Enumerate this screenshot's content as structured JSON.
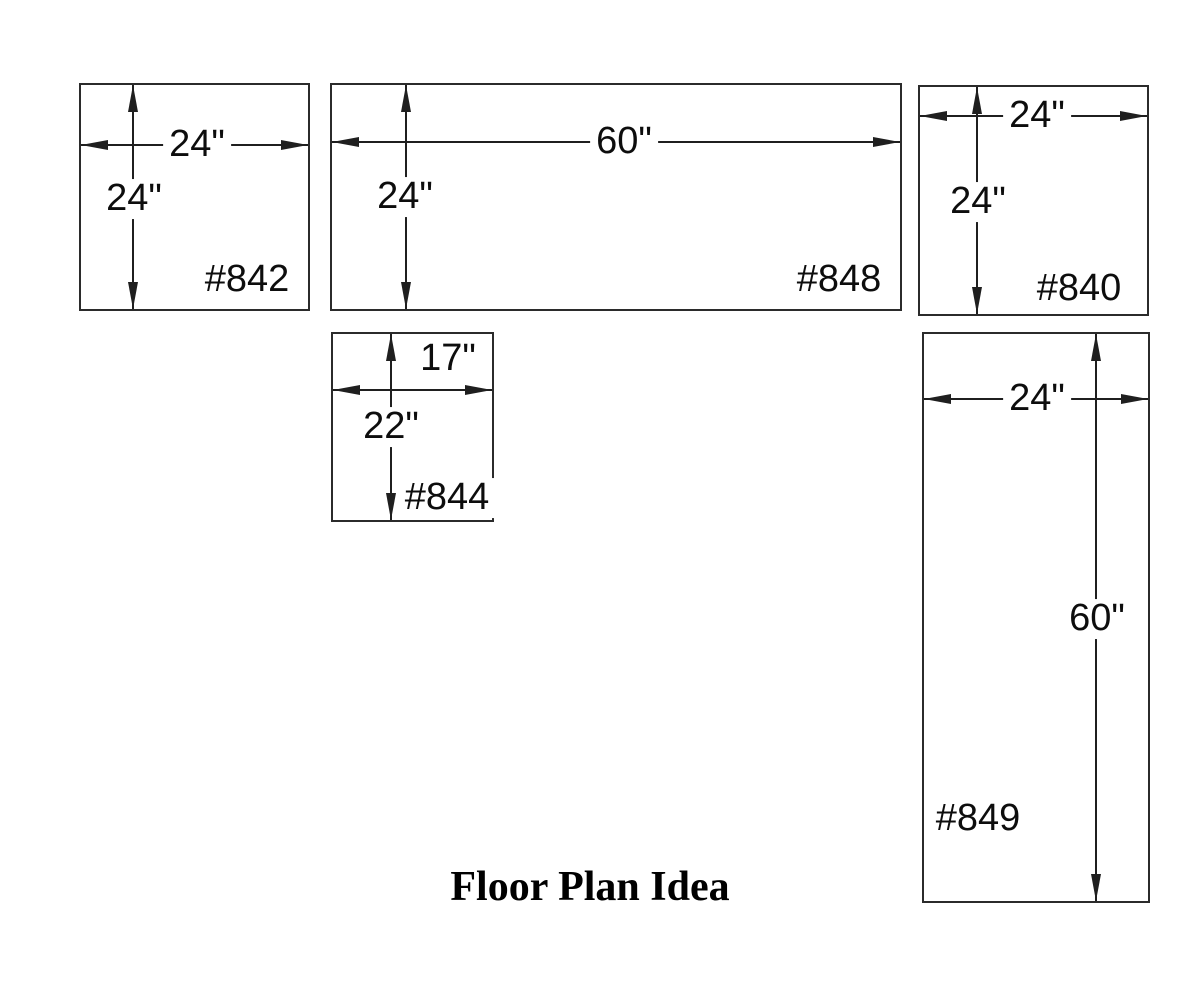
{
  "title": "Floor Plan Idea",
  "colors": {
    "line": "#1f1f1f",
    "border": "#2b2b2b",
    "background": "#ffffff",
    "text": "#0d0d0d"
  },
  "units": [
    {
      "id": "#842",
      "width_label": "24\"",
      "height_label": "24\"",
      "width_inches": 24,
      "height_inches": 24
    },
    {
      "id": "#848",
      "width_label": "60\"",
      "height_label": "24\"",
      "width_inches": 60,
      "height_inches": 24
    },
    {
      "id": "#840",
      "width_label": "24\"",
      "height_label": "24\"",
      "width_inches": 24,
      "height_inches": 24
    },
    {
      "id": "#844",
      "width_label": "17\"",
      "height_label": "22\"",
      "width_inches": 17,
      "height_inches": 22
    },
    {
      "id": "#849",
      "width_label": "24\"",
      "height_label": "60\"",
      "width_inches": 24,
      "height_inches": 60
    }
  ]
}
